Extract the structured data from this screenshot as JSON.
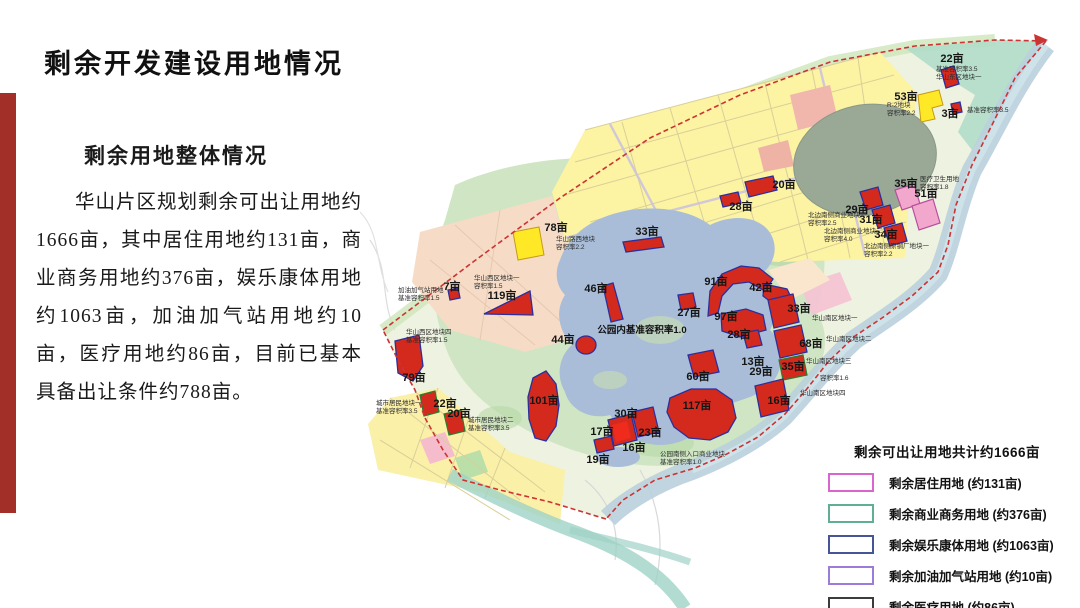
{
  "page": {
    "title": "剩余开发建设用地情况"
  },
  "left_panel": {
    "subtitle": "剩余用地整体情况",
    "paragraph": "华山片区规划剩余可出让用地约1666亩，其中居住用地约131亩，商业商务用地约376亩，娱乐康体用地约1063亩，加油加气站用地约10亩，医疗用地约86亩，目前已基本具备出让条件约788亩。"
  },
  "map": {
    "park_note": {
      "t": "公园内基准容积率1.0",
      "x": 282,
      "y": 333
    },
    "area_labels": [
      {
        "t": "22亩",
        "x": 592,
        "y": 62
      },
      {
        "t": "53亩",
        "x": 546,
        "y": 100
      },
      {
        "t": "3亩",
        "x": 590,
        "y": 117
      },
      {
        "t": "20亩",
        "x": 424,
        "y": 188
      },
      {
        "t": "28亩",
        "x": 381,
        "y": 210
      },
      {
        "t": "78亩",
        "x": 196,
        "y": 231
      },
      {
        "t": "33亩",
        "x": 287,
        "y": 235
      },
      {
        "t": "7亩",
        "x": 92,
        "y": 290
      },
      {
        "t": "119亩",
        "x": 142,
        "y": 299
      },
      {
        "t": "46亩",
        "x": 236,
        "y": 292
      },
      {
        "t": "44亩",
        "x": 203,
        "y": 343
      },
      {
        "t": "91亩",
        "x": 356,
        "y": 285
      },
      {
        "t": "42亩",
        "x": 401,
        "y": 291
      },
      {
        "t": "27亩",
        "x": 329,
        "y": 316
      },
      {
        "t": "97亩",
        "x": 366,
        "y": 320
      },
      {
        "t": "28亩",
        "x": 379,
        "y": 338
      },
      {
        "t": "33亩",
        "x": 439,
        "y": 312
      },
      {
        "t": "68亩",
        "x": 451,
        "y": 347
      },
      {
        "t": "13亩",
        "x": 393,
        "y": 365
      },
      {
        "t": "29亩",
        "x": 401,
        "y": 375
      },
      {
        "t": "35亩",
        "x": 433,
        "y": 370
      },
      {
        "t": "60亩",
        "x": 338,
        "y": 380
      },
      {
        "t": "16亩",
        "x": 419,
        "y": 404
      },
      {
        "t": "117亩",
        "x": 337,
        "y": 409
      },
      {
        "t": "101亩",
        "x": 184,
        "y": 404
      },
      {
        "t": "30亩",
        "x": 266,
        "y": 417
      },
      {
        "t": "17亩",
        "x": 242,
        "y": 435
      },
      {
        "t": "23亩",
        "x": 290,
        "y": 436
      },
      {
        "t": "16亩",
        "x": 274,
        "y": 451
      },
      {
        "t": "19亩",
        "x": 238,
        "y": 463
      },
      {
        "t": "22亩",
        "x": 85,
        "y": 407
      },
      {
        "t": "20亩",
        "x": 99,
        "y": 417
      },
      {
        "t": "79亩",
        "x": 54,
        "y": 381
      },
      {
        "t": "29亩",
        "x": 497,
        "y": 213
      },
      {
        "t": "31亩",
        "x": 511,
        "y": 223
      },
      {
        "t": "34亩",
        "x": 526,
        "y": 238
      },
      {
        "t": "35亩",
        "x": 546,
        "y": 187
      },
      {
        "t": "51亩",
        "x": 566,
        "y": 197
      }
    ],
    "notes": [
      {
        "x": 576,
        "y": 71,
        "lines": [
          "基准容积率3.5",
          "华山东区地块一"
        ]
      },
      {
        "x": 527,
        "y": 107,
        "lines": [
          "R-2地块",
          "容积率2.2"
        ]
      },
      {
        "x": 607,
        "y": 112,
        "lines": [
          "基准容积率3.5"
        ]
      },
      {
        "x": 560,
        "y": 181,
        "lines": [
          "医疗卫生用地",
          "容积率1.8"
        ]
      },
      {
        "x": 448,
        "y": 217,
        "lines": [
          "北边南侧商业地块一",
          "容积率2.5"
        ]
      },
      {
        "x": 464,
        "y": 233,
        "lines": [
          "北边南侧商业地块二",
          "容积率4.0"
        ]
      },
      {
        "x": 504,
        "y": 248,
        "lines": [
          "北边南侧原钢厂地块一",
          "容积率2.2"
        ]
      },
      {
        "x": 196,
        "y": 241,
        "lines": [
          "华山路西地块",
          "容积率2.2"
        ]
      },
      {
        "x": 114,
        "y": 280,
        "lines": [
          "华山西区地块一",
          "容积率1.5"
        ]
      },
      {
        "x": 38,
        "y": 292,
        "lines": [
          "加油加气站用地",
          "基准容积率1.5"
        ]
      },
      {
        "x": 46,
        "y": 334,
        "lines": [
          "华山西区地块四",
          "基准容积率1.5"
        ]
      },
      {
        "x": 16,
        "y": 405,
        "lines": [
          "城市居民地块一",
          "基准容积率3.5"
        ]
      },
      {
        "x": 108,
        "y": 422,
        "lines": [
          "城市居民地块二",
          "基准容积率3.5"
        ]
      },
      {
        "x": 452,
        "y": 320,
        "lines": [
          "华山南区地块一"
        ]
      },
      {
        "x": 466,
        "y": 341,
        "lines": [
          "华山南区地块二"
        ]
      },
      {
        "x": 446,
        "y": 363,
        "lines": [
          "华山南区地块三"
        ]
      },
      {
        "x": 460,
        "y": 380,
        "lines": [
          "容积率1.6"
        ]
      },
      {
        "x": 440,
        "y": 395,
        "lines": [
          "华山南区地块四"
        ]
      },
      {
        "x": 300,
        "y": 456,
        "lines": [
          "公园南侧入口商业地块",
          "基准容积率1.0"
        ]
      }
    ]
  },
  "legend": {
    "title": "剩余可出让用地共计约1666亩",
    "items": [
      {
        "label": "剩余居住用地 (约131亩)",
        "color": "#d966cc"
      },
      {
        "label": "剩余商业商务用地 (约376亩)",
        "color": "#5fae96"
      },
      {
        "label": "剩余娱乐康体用地 (约1063亩)",
        "color": "#46549a"
      },
      {
        "label": "剩余加油加气站用地 (约10亩)",
        "color": "#9d7bd8"
      },
      {
        "label": "剩余医疗用地 (约86亩)",
        "color": "#3c3c3c"
      }
    ]
  }
}
